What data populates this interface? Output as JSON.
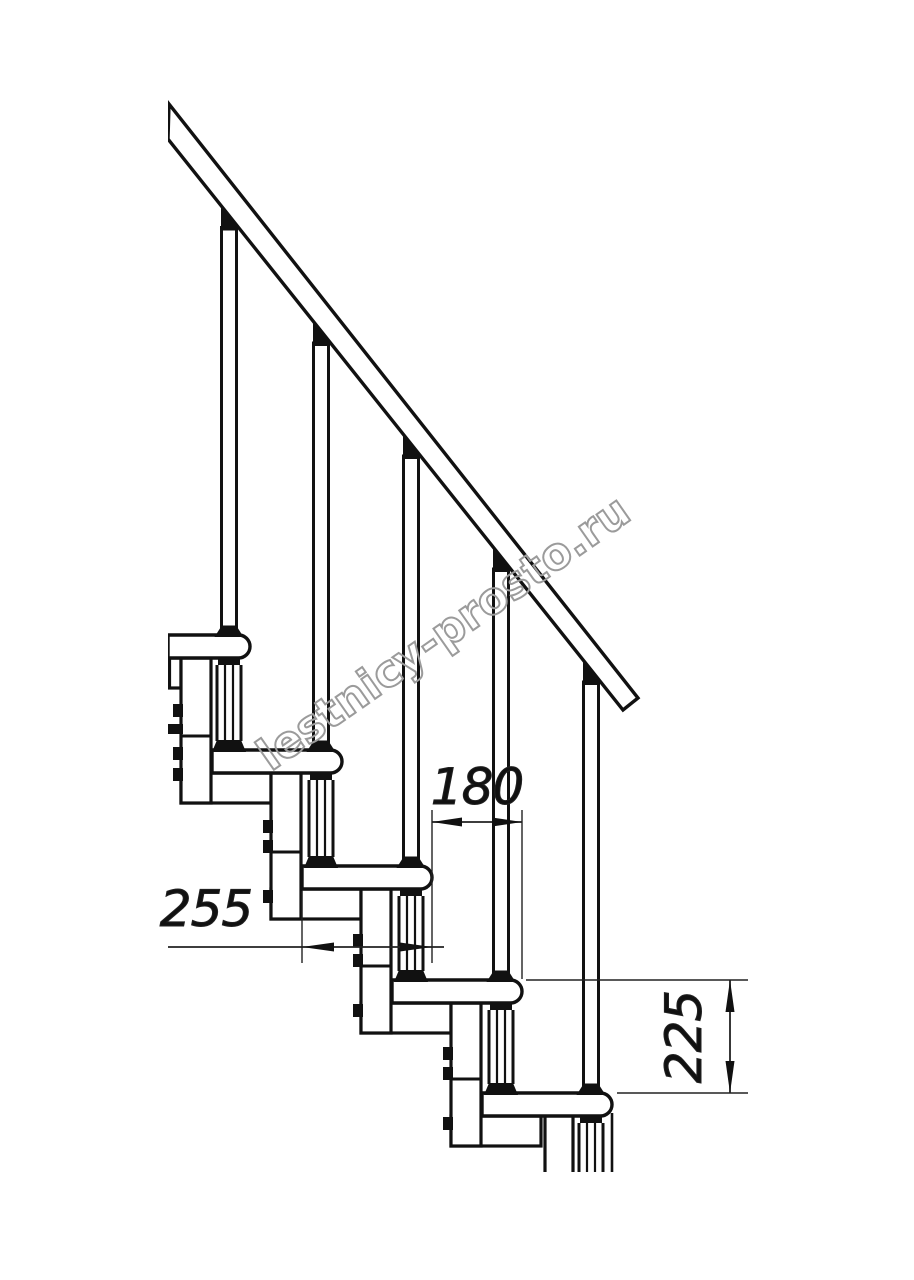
{
  "drawing": {
    "title": "modular-staircase-side-view",
    "watermark": "lestnicy-prosto.ru",
    "dimensions": {
      "run": {
        "value": "180"
      },
      "tread_depth": {
        "value": "255"
      },
      "riser_height": {
        "value": "225"
      }
    },
    "counts": {
      "treads": 5,
      "balusters": 5
    },
    "colors": {
      "line": "#111111",
      "thin_line": "#222222",
      "watermark": "#9b9b9b",
      "background": "#ffffff"
    }
  }
}
